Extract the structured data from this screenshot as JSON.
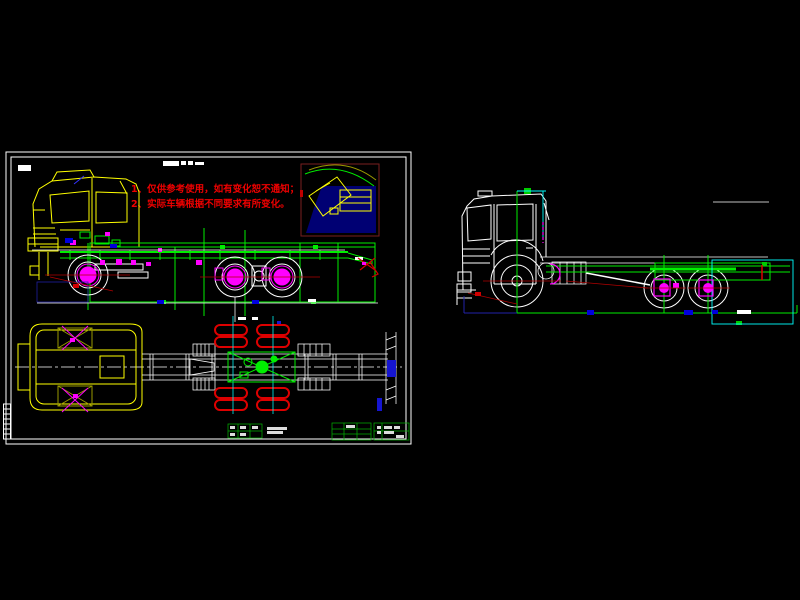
{
  "canvas": {
    "width": 800,
    "height": 600,
    "background": "#000000"
  },
  "notes": {
    "line1": "1、仅供参考使用，如有变化恕不通知；",
    "line2": "2、实际车辆根据不同要求有所变化。",
    "color": "#ee0000"
  },
  "colors": {
    "cab_outline": "#ffff00",
    "chassis_green": "#00ee00",
    "detail_magenta": "#ff00ff",
    "tire_red": "#dd0000",
    "dimension_white": "#ffffff",
    "dimension_cyan": "#00ffff",
    "marker_blue": "#0000dd",
    "centerline_red": "#b00000",
    "inset_border": "#7a1f1f",
    "inset_fill": "#000080",
    "olive": "#9a9a00",
    "navy": "#2222aa"
  }
}
